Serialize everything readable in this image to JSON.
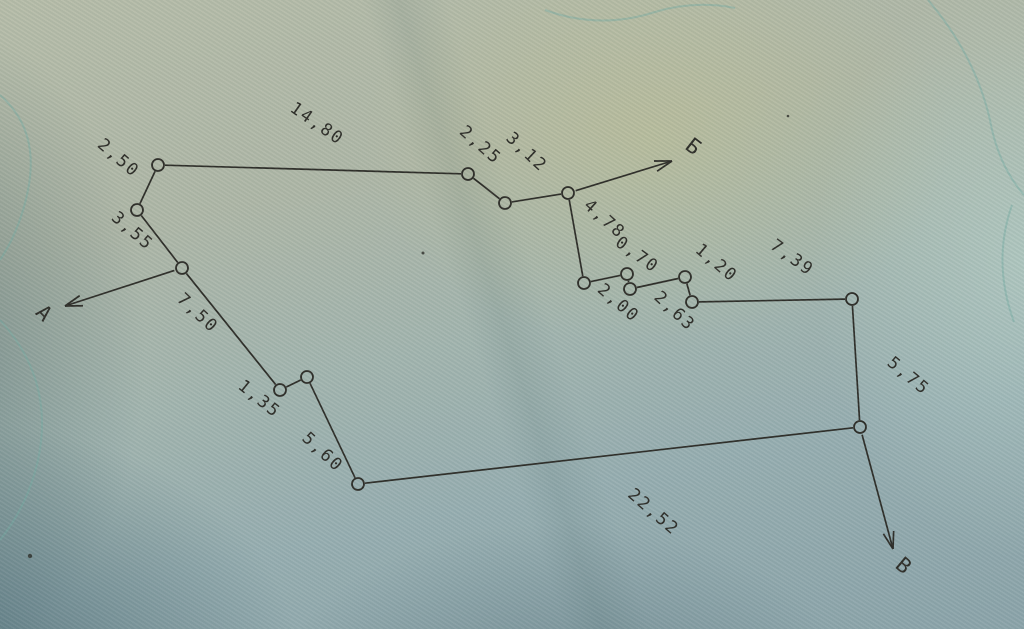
{
  "figure": {
    "type": "closed-traverse-sketch",
    "ink_color": "#2b2a25",
    "contour_color": "#74aaa2",
    "node_radius": 6,
    "line_width": 1.7,
    "font_size_distance": 17,
    "font_size_reference": 21,
    "nodes": [
      {
        "x": 158,
        "y": 165
      },
      {
        "x": 468,
        "y": 174
      },
      {
        "x": 505,
        "y": 203
      },
      {
        "x": 568,
        "y": 193
      },
      {
        "x": 584,
        "y": 283
      },
      {
        "x": 627,
        "y": 274
      },
      {
        "x": 630,
        "y": 289
      },
      {
        "x": 685,
        "y": 277
      },
      {
        "x": 692,
        "y": 302
      },
      {
        "x": 852,
        "y": 299
      },
      {
        "x": 860,
        "y": 427
      },
      {
        "x": 358,
        "y": 484
      },
      {
        "x": 307,
        "y": 377
      },
      {
        "x": 280,
        "y": 390
      },
      {
        "x": 182,
        "y": 268
      },
      {
        "x": 137,
        "y": 210
      }
    ],
    "edges": [
      {
        "from": 0,
        "to": 1,
        "label": "14,80",
        "lx": 314,
        "ly": 128,
        "rot": 35
      },
      {
        "from": 1,
        "to": 2,
        "label": "2,25",
        "lx": 477,
        "ly": 149,
        "rot": 41
      },
      {
        "from": 2,
        "to": 3,
        "label": "3,12",
        "lx": 523,
        "ly": 156,
        "rot": 43
      },
      {
        "from": 3,
        "to": 4,
        "label": "4,78",
        "lx": 601,
        "ly": 223,
        "rot": 42
      },
      {
        "from": 4,
        "to": 5,
        "label": "2,00",
        "lx": 615,
        "ly": 307,
        "rot": 41
      },
      {
        "from": 5,
        "to": 6,
        "label": "0,70",
        "lx": 634,
        "ly": 259,
        "rot": 36
      },
      {
        "from": 6,
        "to": 7,
        "label": "2,63",
        "lx": 671,
        "ly": 315,
        "rot": 43
      },
      {
        "from": 7,
        "to": 8,
        "label": "1,20",
        "lx": 713,
        "ly": 267,
        "rot": 40
      },
      {
        "from": 8,
        "to": 9,
        "label": "7,39",
        "lx": 789,
        "ly": 262,
        "rot": 36
      },
      {
        "from": 9,
        "to": 10,
        "label": "5,75",
        "lx": 905,
        "ly": 380,
        "rot": 40
      },
      {
        "from": 10,
        "to": 11,
        "label": "22,52",
        "lx": 650,
        "ly": 516,
        "rot": 41
      },
      {
        "from": 11,
        "to": 12,
        "label": "5,60",
        "lx": 319,
        "ly": 456,
        "rot": 43
      },
      {
        "from": 12,
        "to": 13,
        "label": "1,35",
        "lx": 256,
        "ly": 403,
        "rot": 39
      },
      {
        "from": 13,
        "to": 14,
        "label": "7,50",
        "lx": 194,
        "ly": 317,
        "rot": 43
      },
      {
        "from": 14,
        "to": 15,
        "label": "3,55",
        "lx": 129,
        "ly": 235,
        "rot": 41
      },
      {
        "from": 15,
        "to": 0,
        "label": "2,50",
        "lx": 115,
        "ly": 162,
        "rot": 41
      }
    ],
    "reference_arrows": [
      {
        "letter": "А",
        "from": 14,
        "tip_x": 65,
        "tip_y": 306,
        "lx": 39,
        "ly": 318,
        "rot": 45
      },
      {
        "letter": "Б",
        "from": 3,
        "tip_x": 672,
        "tip_y": 161,
        "lx": 689,
        "ly": 152,
        "rot": 38
      },
      {
        "letter": "В",
        "from": 10,
        "tip_x": 893,
        "tip_y": 549,
        "lx": 899,
        "ly": 571,
        "rot": 40
      }
    ],
    "contours": [
      {
        "d": "M 928,0 Q 975,55 990,120 Q 998,165 1024,195"
      },
      {
        "d": "M 1012,205 Q 992,262 1014,322"
      },
      {
        "d": "M 0,320 Q 55,380 38,460 Q 28,505 0,540"
      },
      {
        "d": "M 0,95 Q 40,130 28,190 Q 20,230 0,260"
      },
      {
        "d": "M 545,10 Q 600,30 655,12 Q 695,0 735,8"
      }
    ],
    "specks": [
      {
        "x": 423,
        "y": 253,
        "r": 1.5
      },
      {
        "x": 30,
        "y": 556,
        "r": 2.2
      },
      {
        "x": 788,
        "y": 116,
        "r": 1.3
      }
    ]
  }
}
